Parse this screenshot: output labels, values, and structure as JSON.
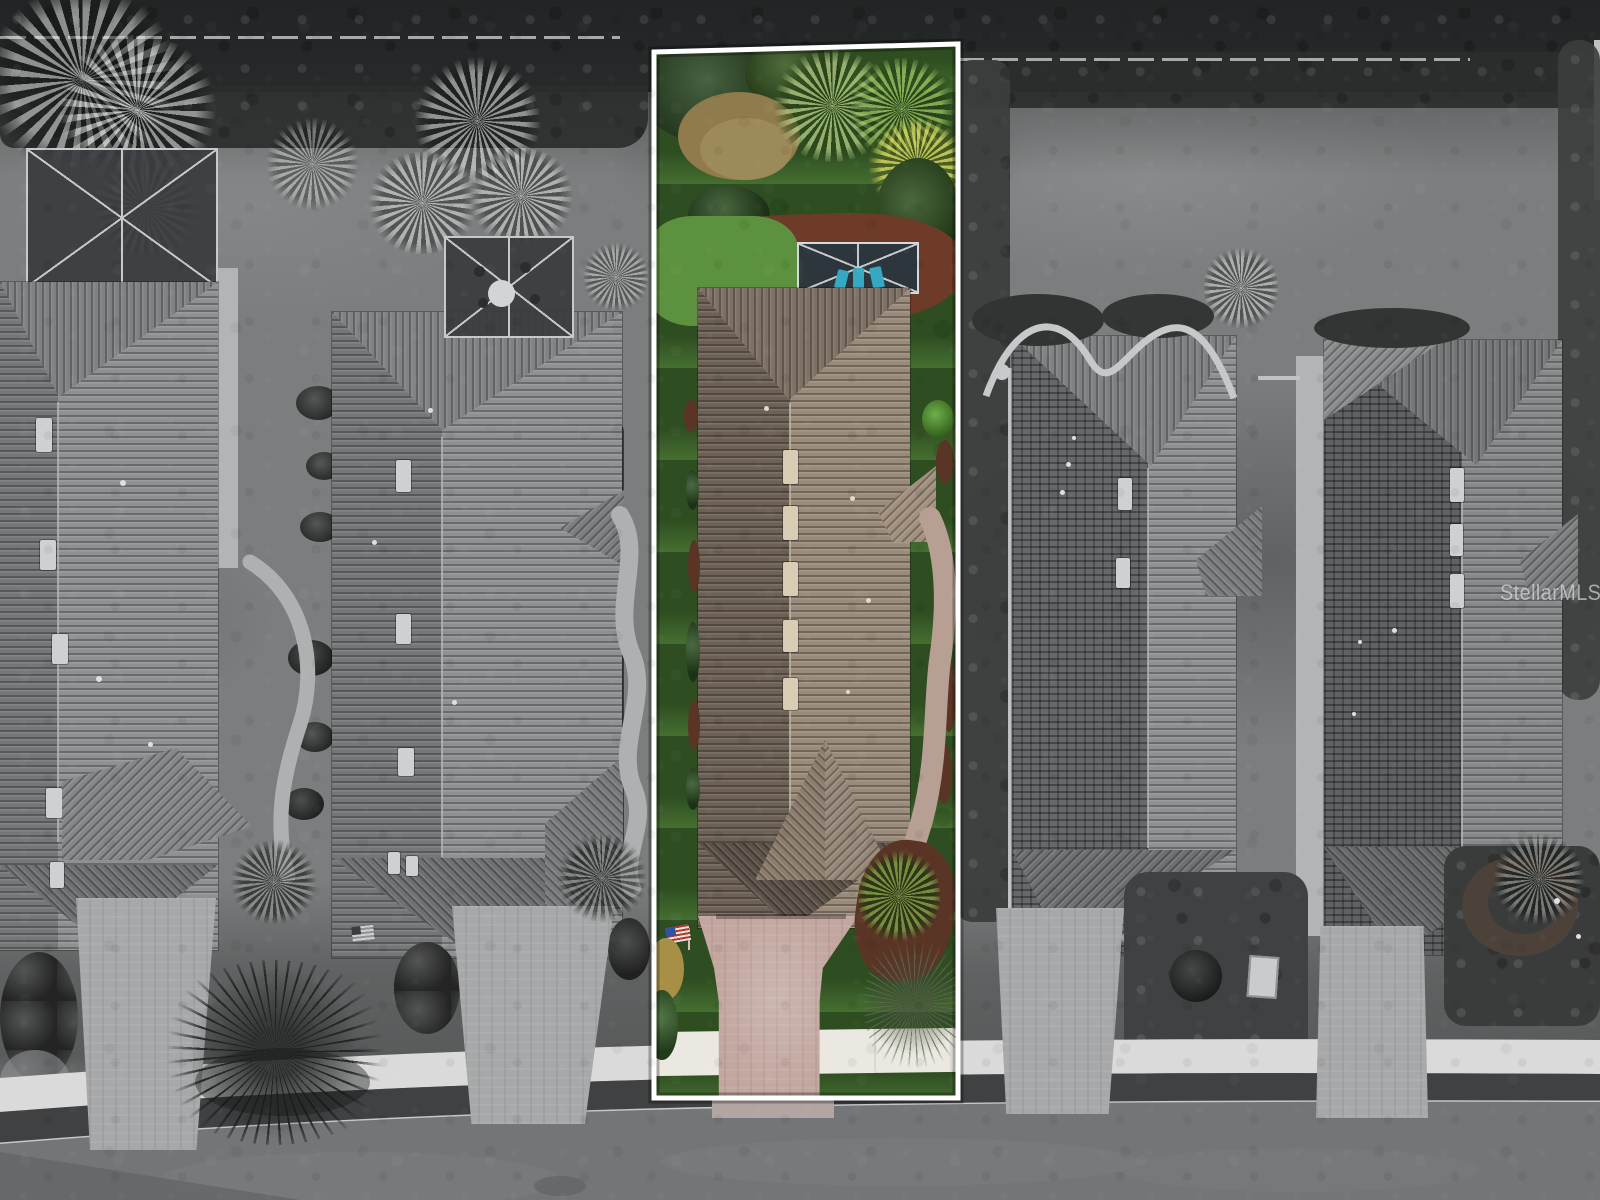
{
  "watermark": {
    "text": "StellarMLS",
    "color": "rgba(255,255,255,0.55)"
  },
  "scene": {
    "type": "aerial-drone-photo",
    "subject": "five-tile-roof-homes-row",
    "featured_lot_highlight": "color-on-grayscale",
    "boundary_outline": "white"
  },
  "colors": {
    "field": "#7b7d7e",
    "canopy": "#232626",
    "hedge": "#2b2e2d",
    "fence": "#c8cac9",
    "veg_dark": "#3c3e3d",
    "road": "#737578",
    "road_dark": "#616365",
    "verge": "#3f4142",
    "curb": "#c5c7c8",
    "sidewalk_gray": "#d9dad9",
    "wall_gray": "#b2b4b5",
    "gutter": "#c0c2c3",
    "roof_gray": "#8e9092",
    "roof_gray_dark": "#747678",
    "roof_grid": "#66686a",
    "roof_gable_gray": "#6e7072",
    "ridge_gray": "#b4b6b7",
    "skylight_gray": "#ced0d2",
    "cage_screen": "rgba(56,60,62,0.92)",
    "cage_frame": "#c6c8c9",
    "drive_gray": "#a6a8a9",
    "walk_gray": "#aeb0b1",
    "lawn_green": "#5c9140",
    "lawn_light": "#79b357",
    "bush_dark": "#2c4a24",
    "palm_bright": "#79ad3f",
    "palm_yellow": "#c9c952",
    "dry_tan": "#907b4d",
    "mulch": "#6d3b27",
    "mulch_dark": "#5a3525",
    "roof_tan_left": "#6d6156",
    "roof_tan_right": "#9a8a7a",
    "roof_tan_hip": "#7d7064",
    "roof_tan_gable": "#5c5248",
    "ridge_tan": "#c3b6a2",
    "skylight_tan": "#d9ccb4",
    "pool_screen": "rgba(40,54,62,0.92)",
    "pool_frame": "#d3dade",
    "chair_teal": "#36a9c2",
    "drive_pink": "#c2a69f",
    "apron_pink": "#b2a6a2",
    "sidewalk_white": "#eae8e0",
    "walk_path_tan": "#b7a093",
    "flag_red": "#b03a32",
    "flag_white": "#e9e5da",
    "flag_blue": "#31529e",
    "tree_gray_green": "#6f7a66",
    "outline": "#ffffff"
  }
}
